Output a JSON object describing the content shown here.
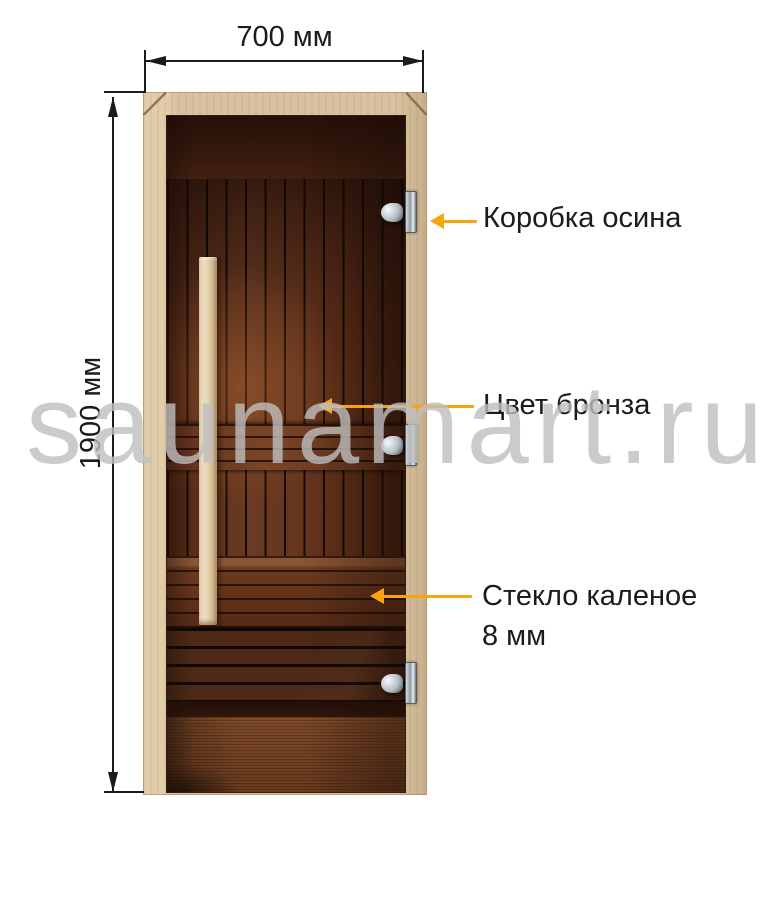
{
  "watermark": {
    "text": "saunamart.ru"
  },
  "dimensions": {
    "width_label": "700 мм",
    "height_label": "1900 мм"
  },
  "callouts": {
    "frame": {
      "text": "Коробка осина"
    },
    "tint": {
      "text": "Цвет бронза"
    },
    "glass": {
      "line1": "Стекло каленое",
      "line2": "8 мм"
    }
  },
  "colors": {
    "arrow": "#F8A410",
    "line": "#1B1B1B",
    "text": "#1B1B1B",
    "watermark": "#BFBFBF",
    "frame_wood": "#D9C2A1",
    "handle_wood": "#E9D6B6",
    "glass_top": "#31170D",
    "plank_brown": "#6B3A22",
    "floor_brown": "#7E4A28"
  }
}
